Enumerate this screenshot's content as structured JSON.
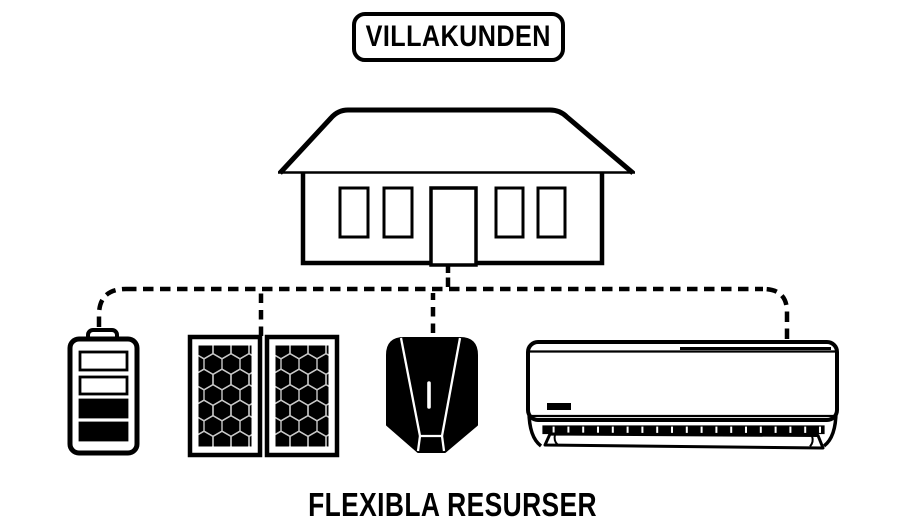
{
  "title_badge": {
    "label": "VILLAKUNDEN"
  },
  "caption": {
    "label": "FLEXIBLA RESURSER"
  },
  "colors": {
    "ink": "#000000",
    "background": "#ffffff",
    "solar_cell_grid": "#c8c8c8",
    "charger_detail": "#ffffff"
  },
  "diagram": {
    "top_node": {
      "icon": "house-icon"
    },
    "connection_style": "dashed",
    "flexible_resources": [
      {
        "icon": "battery-icon"
      },
      {
        "icon": "solar-panels-icon"
      },
      {
        "icon": "ev-charger-icon"
      },
      {
        "icon": "heat-pump-icon"
      }
    ]
  }
}
